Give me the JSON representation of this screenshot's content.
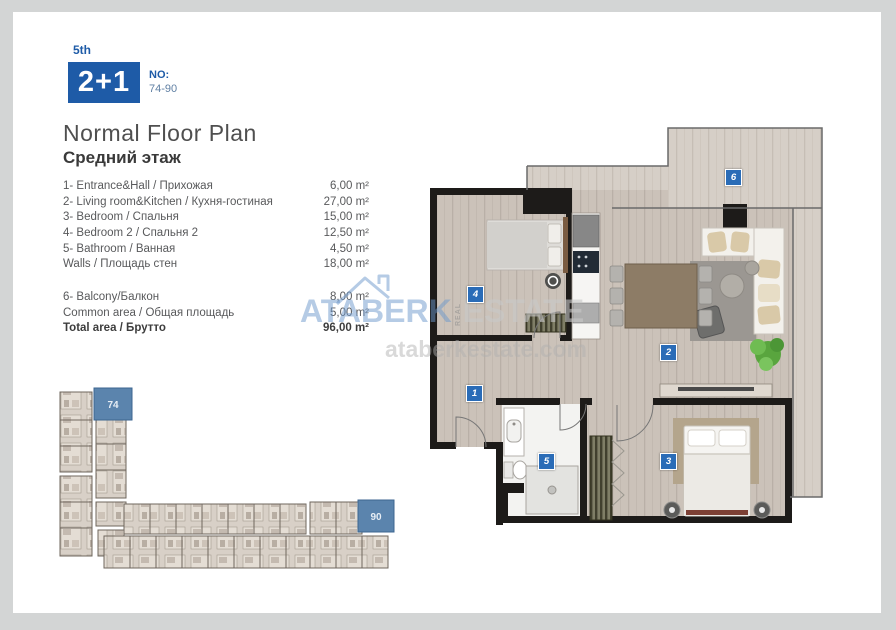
{
  "header": {
    "floor": "5th",
    "unit_type": "2+1",
    "no_label": "NO:",
    "no_value": "74-90"
  },
  "title": {
    "line1": "Normal Floor Plan",
    "line2": "Средний этаж"
  },
  "rooms": [
    {
      "label": "1- Entrance&Hall / Прихожая",
      "area": "6,00 m²"
    },
    {
      "label": "2- Living room&Kitchen / Кухня-гостиная",
      "area": "27,00 m²"
    },
    {
      "label": "3- Bedroom / Спальня",
      "area": "15,00 m²"
    },
    {
      "label": "4- Bedroom 2 / Спальня 2",
      "area": "12,50 m²"
    },
    {
      "label": "5- Bathroom / Ванная",
      "area": "4,50 m²"
    },
    {
      "label": "Walls / Площадь стен",
      "area": "18,00 m²"
    }
  ],
  "extras": [
    {
      "label": "6- Balcony/Балкон",
      "area": "8,00 m²"
    },
    {
      "label": "Common area / Общая площадь",
      "area": "5,00 m²"
    }
  ],
  "total": {
    "label": "Total area / Брутто",
    "area": "96,00 m²"
  },
  "floor_plan": {
    "markers": [
      "1",
      "2",
      "3",
      "4",
      "5",
      "6"
    ]
  },
  "overview": {
    "units": [
      "74",
      "90"
    ]
  },
  "watermark": {
    "brand": "ATABERK",
    "vertical": "REAL",
    "brand2": "ESTATE",
    "site": "ataberkestate.com"
  },
  "colors": {
    "brand_blue": "#1e5ba7",
    "marker_blue": "#2a6cb7",
    "highlight_unit_blue": "#5b84ad",
    "wall_black": "#1d1b19",
    "wood_floor": "#cbc2b9"
  }
}
